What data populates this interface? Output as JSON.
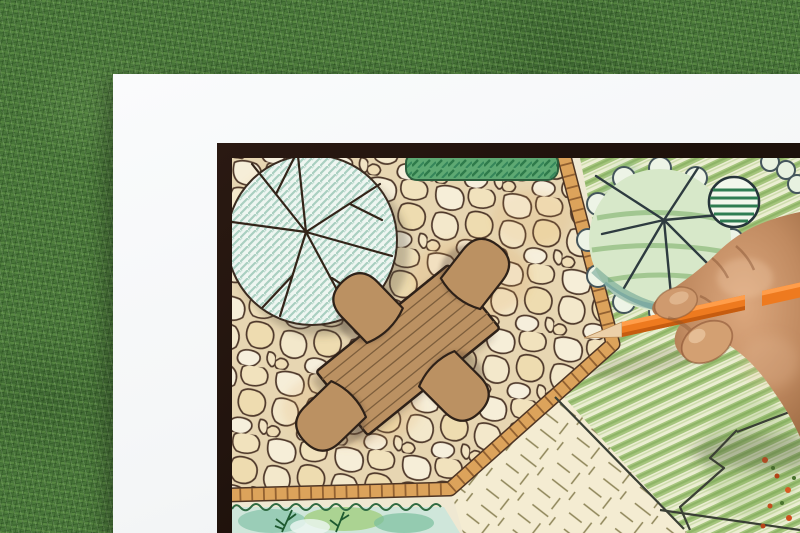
{
  "scene": {
    "type": "photograph",
    "aria": "Overhead photo of a hand drawing a garden landscape plan with an orange colored pencil on a white sheet lying on a grass lawn",
    "background_label": "grass lawn",
    "paper_label": "white paper sheet",
    "board_label": "dark-framed garden plan drawing"
  },
  "palette": {
    "grass_green": "#49763a",
    "paper_white": "#f8f9fa",
    "frame_black": "#241510",
    "flagstone_cream": "#f3e7c9",
    "stone_outline_brown": "#4e382a",
    "brick_border_orange": "#dca35b",
    "furniture_wood_brown": "#bb9162",
    "tree_canopy_mint": "#eef6f1",
    "tree_hatch_teal": "#a9cfc0",
    "hedge_green": "#5ea973",
    "lawn_cream": "#f4ecd2",
    "field_green": "#9abf6e",
    "pencil_orange": "#ee7a1f",
    "skin_tone": "#c6906a"
  },
  "plan": {
    "elements": [
      {
        "id": "shade-tree",
        "kind": "large round tree canopy with teal hatching and radiating branches"
      },
      {
        "id": "flagstone-patio",
        "kind": "irregular flagstone paving"
      },
      {
        "id": "brick-border",
        "kind": "brick soldier-course edging strip"
      },
      {
        "id": "hedge-row",
        "kind": "clipped hedge band at top"
      },
      {
        "id": "dining-set",
        "kind": "rectangular plank table with four round-back chairs"
      },
      {
        "id": "lawn-panel",
        "kind": "lawn wedge with grass tick marks"
      },
      {
        "id": "planting-bed",
        "kind": "watercolor planting bed with fern sprigs"
      },
      {
        "id": "field-tree",
        "kind": "scalloped-outline tree over striped green groundcover"
      },
      {
        "id": "shrub-blob",
        "kind": "dark hatched shrub"
      },
      {
        "id": "flower-bed",
        "kind": "red-orange flower dots at lower right"
      }
    ]
  },
  "hand": {
    "label": "right hand gripping an orange colored pencil, tip at the brick border corner",
    "pencil_color": "#ee7a1f"
  }
}
